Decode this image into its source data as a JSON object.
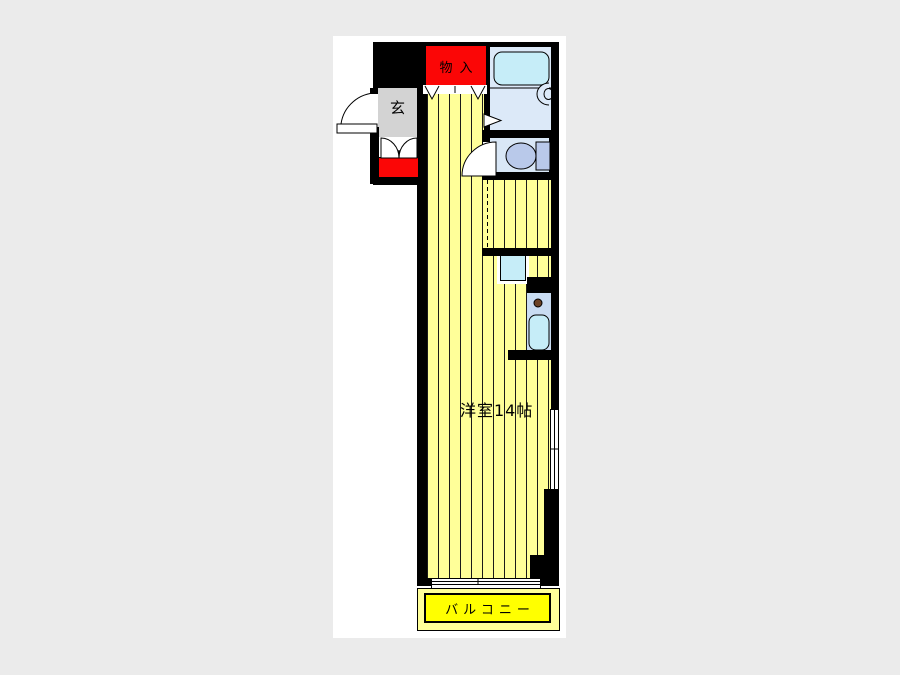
{
  "floorplan": {
    "rooms": {
      "closet_label": "物入",
      "entrance_label": "玄",
      "main_room_label": "洋室14帖",
      "balcony_label": "バルコニー"
    },
    "fixtures": [
      "bathtub-icon",
      "washbasin-icon",
      "bathroom-door-icon",
      "toilet-icon",
      "toilet-door-arc-icon",
      "entrance-door-arc-icon",
      "double-door-icon",
      "folding-closet-door-icon",
      "washer-pan-icon",
      "stove-knob-icon",
      "kitchen-sink-icon",
      "window-icon",
      "sliding-door-icon",
      "partition-dashed-line"
    ],
    "colors": {
      "page_bg": "#ebebeb",
      "paper": "#ffffff",
      "wall": "#000000",
      "room_fill": "#ffff99",
      "stripe": "#1a1a1a",
      "red": "#fb0606",
      "balcony_yellow": "#ffff00",
      "bath_room": "#dce9f8",
      "tub": "#c6edf8",
      "toilet_room": "#d9e7f6",
      "fixture_blue": "#b9c9ea",
      "kitchen": "#c9dcf2",
      "entrance_gray": "#d3d3d3",
      "knob": "#6b4226"
    }
  }
}
